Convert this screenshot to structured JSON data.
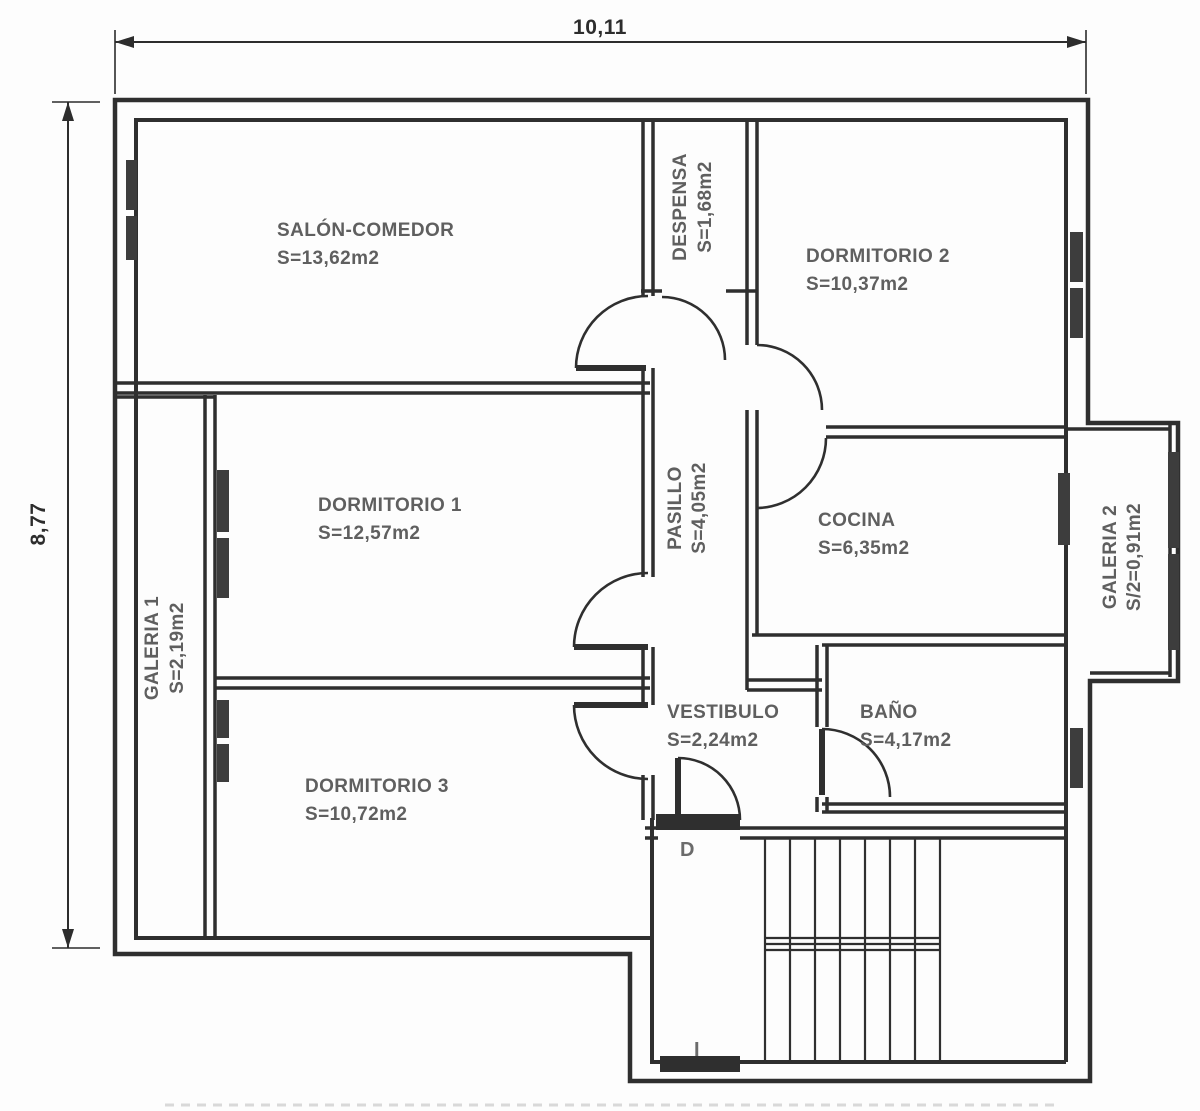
{
  "title": "floor-plan",
  "dimensions": {
    "width_label": "10,11",
    "height_label": "8,77"
  },
  "rooms": [
    {
      "id": "salon-comedor",
      "name": "SALÓN-COMEDOR",
      "area": "S=13,62m2"
    },
    {
      "id": "despensa",
      "name": "DESPENSA",
      "area": "S=1,68m2"
    },
    {
      "id": "dormitorio-2",
      "name": "DORMITORIO 2",
      "area": "S=10,37m2"
    },
    {
      "id": "dormitorio-1",
      "name": "DORMITORIO 1",
      "area": "S=12,57m2"
    },
    {
      "id": "pasillo",
      "name": "PASILLO",
      "area": "S=4,05m2"
    },
    {
      "id": "cocina",
      "name": "COCINA",
      "area": "S=6,35m2"
    },
    {
      "id": "galeria-1",
      "name": "GALERIA 1",
      "area": "S=2,19m2"
    },
    {
      "id": "galeria-2",
      "name": "GALERIA 2",
      "area": "S/2=0,91m2"
    },
    {
      "id": "vestibulo",
      "name": "VESTIBULO",
      "area": "S=2,24m2"
    },
    {
      "id": "bano",
      "name": "BAÑO",
      "area": "S=4,17m2"
    },
    {
      "id": "dormitorio-3",
      "name": "DORMITORIO 3",
      "area": "S=10,72m2"
    }
  ],
  "stairs": {
    "letter_down": "D",
    "letter_up": "I"
  },
  "colors": {
    "wall": "#2f2f2f",
    "window": "#3d3d3d",
    "label": "#5f5f5f",
    "dimension": "#2d2d2d",
    "background": "#fdfdfd",
    "stair_letter": "#6b6b6b"
  }
}
